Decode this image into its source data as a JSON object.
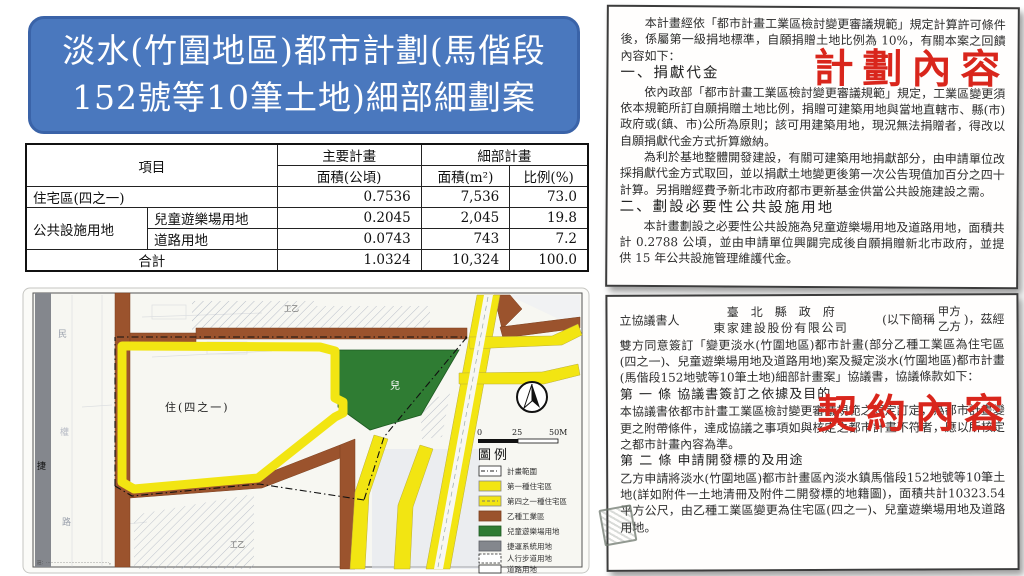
{
  "title": {
    "line1": "淡水(竹圍地區)都市計劃(馬偕段",
    "line2": "152號等10筆土地)細部細劃案"
  },
  "table": {
    "headers": {
      "item": "項目",
      "main_plan": "主要計畫",
      "detail_plan": "細部計畫",
      "area_ha": "面積(公頃)",
      "area_m2": "面積(m²)",
      "ratio": "比例(%)"
    },
    "rows": [
      {
        "item": "住宅區(四之一)",
        "area_ha": "0.7536",
        "area_m2": "7,536",
        "ratio": "73.0"
      },
      {
        "item": "公共設施用地",
        "sub": "兒童遊樂場用地",
        "area_ha": "0.2045",
        "area_m2": "2,045",
        "ratio": "19.8"
      },
      {
        "sub": "道路用地",
        "area_ha": "0.0743",
        "area_m2": "743",
        "ratio": "7.2"
      },
      {
        "item": "合計",
        "area_ha": "1.0324",
        "area_m2": "10,324",
        "ratio": "100.0"
      }
    ]
  },
  "map": {
    "labels": {
      "residential": "住(四之一)",
      "children": "兒",
      "industrial_top": "工乙",
      "industrial_bottom": "工乙",
      "mrt": "捷",
      "street_char_1": "民",
      "street_char_2": "權",
      "street_char_3": "路",
      "note": "註：⋯⋯⋯⋯⋯⋯⋯⋯⋯⋯⋯⋯⋯⋯。"
    },
    "scale": {
      "start": "0",
      "mid": "25",
      "end": "50M"
    },
    "legend": {
      "title": "圖例",
      "items": [
        {
          "label": "計畫範圍"
        },
        {
          "label": "第一種住宅區"
        },
        {
          "label": "第四之一種住宅區"
        },
        {
          "label": "乙種工業區"
        },
        {
          "label": "兒童遊樂場用地"
        },
        {
          "label": "捷運系統用地"
        },
        {
          "label": "人行步道用地"
        },
        {
          "label": "道路用地"
        }
      ]
    }
  },
  "plan_doc": {
    "overlay": "計劃內容",
    "intro": "本計畫經依「都市計畫工業區檢討變更審議規範」規定計算許可條件後，係屬第一級捐地標準，自願捐贈土地比例為 10%，有關本案之回饋內容如下：",
    "section1_title": "一、捐獻代金",
    "section1_p1": "依內政部「都市計畫工業區檢討變更審議規範」規定，工業區變更須依本規範所訂自願捐贈土地比例，捐贈可建築用地與當地直轄市、縣(市)政府或(鎮、市)公所為原則；該可用建築用地，現況無法捐贈者，得改以自願捐獻代金方式折算繳納。",
    "section1_p2": "為利於基地整體開發建設，有關可建築用地捐獻部分，由申請單位改採捐獻代金方式取回，並以捐獻土地變更後第一次公告現值加百分之四十計算。另捐贈經費予新北市政府都市更新基金供當公共設施建設之需。",
    "section2_title": "二、劃設必要性公共設施用地",
    "section2_p1": "本計畫劃設之必要性公共設施為兒童遊樂場用地及道路用地，面積共計 0.2788 公頃，並由申請單位興闢完成後自願捐贈新北市政府，並提供 15 年公共設施管理維護代金。"
  },
  "contract_doc": {
    "overlay": "契約內容",
    "opening_prefix": "立協議書人",
    "party_a_name": "臺北縣政府",
    "party_b_name": "東家建設股份有限公司",
    "abbrev_prefix": "(以下簡稱",
    "party_a_abbrev": "甲方",
    "party_b_abbrev": "乙方",
    "abbrev_suffix": ")，茲經",
    "opening_body": "雙方同意簽訂「變更淡水(竹圍地區)都市計畫(部分乙種工業區為住宅區(四之一)、兒童遊樂場用地及道路用地)案及擬定淡水(竹圍地區)都市計畫(馬偕段152地號等10筆土地)細部計畫案」協議書，協議條款如下：",
    "article1_title": "第 一 條 協議書簽訂之依據及目的",
    "article1_body": "本協議書依都市計畫工業區檢討變更審議規範之規定訂定，為都市計畫變更之附帶條件，達成協議之事項如與核定之都市計畫不符者，應以所核定之都市計畫內容為準。",
    "article2_title": "第 二 條 申請開發標的及用途",
    "article2_body": "乙方申請將淡水(竹圍地區)都市計畫區內淡水鎮馬偕段152地號等10筆土地(詳如附件一土地清冊及附件二開發標的地籍圖)，面積共計10323.54平方公尺，由乙種工業區變更為住宅區(四之一)、兒童遊樂場用地及道路用地。"
  },
  "colors": {
    "title_blue": "#4a78be",
    "accent_red": "#d9261c",
    "map_yellow": "#f2e512",
    "map_brown": "#9b532d",
    "map_green": "#2f7c33",
    "map_gray": "#84878d"
  }
}
